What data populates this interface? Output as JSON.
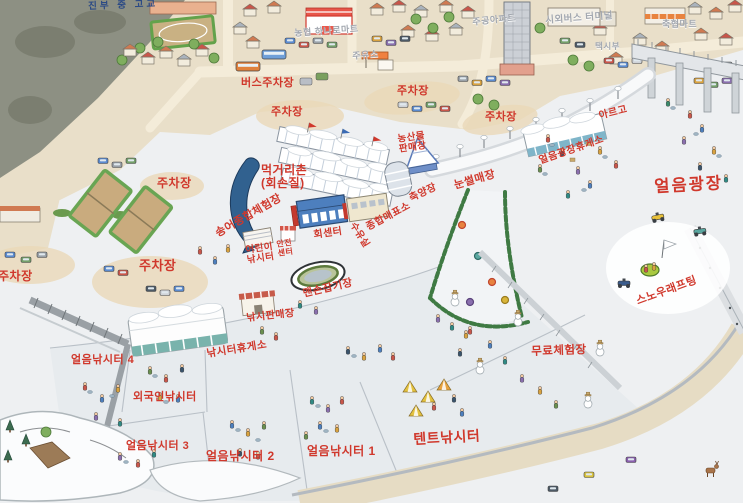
{
  "map": {
    "title_note": "illustrated winter festival site map",
    "colors": {
      "label_red": "#d0382c",
      "label_gray": "#a2a7af",
      "label_navy": "#2b4a85",
      "ice": "#eef0f2",
      "town": "#e9dfc9",
      "road": "#f4ecd9",
      "hill": "#8d9083",
      "fish_blue": "#31618f",
      "hedge_green": "#3f7a43",
      "tent_teal": "#79b3ac"
    },
    "labels": [
      {
        "id": "jinbu-school",
        "lines": [
          "진부 중 고교"
        ],
        "x": 88,
        "y": 2,
        "size": 9.5,
        "color": "navy",
        "rot": -2
      },
      {
        "id": "bus-parking",
        "lines": [
          "버스주차장"
        ],
        "x": 241,
        "y": 78,
        "size": 11,
        "color": "red",
        "rot": 0
      },
      {
        "id": "hanaro-mart",
        "lines": [
          "농협 하나로마트"
        ],
        "x": 294,
        "y": 29,
        "size": 9,
        "color": "gray",
        "rot": -4
      },
      {
        "id": "gas-station",
        "lines": [
          "주유소"
        ],
        "x": 352,
        "y": 52,
        "size": 9,
        "color": "gray",
        "rot": -5
      },
      {
        "id": "jugong-apartment",
        "lines": [
          "주공아파트"
        ],
        "x": 472,
        "y": 18,
        "size": 9,
        "color": "gray",
        "rot": -6
      },
      {
        "id": "intercity-bus-terminal",
        "lines": [
          "시외버스 터미널"
        ],
        "x": 545,
        "y": 16,
        "size": 9.5,
        "color": "gray",
        "rot": -4
      },
      {
        "id": "chukhyup-mart",
        "lines": [
          "축협마트"
        ],
        "x": 662,
        "y": 20,
        "size": 9,
        "color": "gray",
        "rot": 0
      },
      {
        "id": "taxi-stand",
        "lines": [
          "택시부"
        ],
        "x": 595,
        "y": 42,
        "size": 8.5,
        "color": "gray",
        "rot": 0
      },
      {
        "id": "parking-a",
        "lines": [
          "주차장"
        ],
        "x": 397,
        "y": 86,
        "size": 11,
        "color": "red",
        "rot": 0
      },
      {
        "id": "parking-b",
        "lines": [
          "주차장"
        ],
        "x": 271,
        "y": 107,
        "size": 11,
        "color": "red",
        "rot": 0
      },
      {
        "id": "parking-c",
        "lines": [
          "주차장"
        ],
        "x": 485,
        "y": 112,
        "size": 11,
        "color": "red",
        "rot": 0
      },
      {
        "id": "parking-d",
        "lines": [
          "주차장"
        ],
        "x": 157,
        "y": 177,
        "size": 12,
        "color": "red",
        "rot": 0
      },
      {
        "id": "parking-e",
        "lines": [
          "주차장"
        ],
        "x": 139,
        "y": 259,
        "size": 13,
        "color": "red",
        "rot": 0
      },
      {
        "id": "parking-f",
        "lines": [
          "주차장"
        ],
        "x": -2,
        "y": 270,
        "size": 12,
        "color": "red",
        "rot": 0
      },
      {
        "id": "argo",
        "lines": [
          "아르고"
        ],
        "x": 598,
        "y": 112,
        "size": 10,
        "color": "red",
        "rot": -14
      },
      {
        "id": "food-village",
        "lines": [
          "먹거리촌",
          "(회손질)"
        ],
        "x": 261,
        "y": 164,
        "size": 12,
        "color": "red",
        "rot": 0
      },
      {
        "id": "trout-experience",
        "lines": [
          "송어종합체험장"
        ],
        "x": 214,
        "y": 230,
        "size": 11,
        "color": "red",
        "rot": -30
      },
      {
        "id": "farm-products-market",
        "lines": [
          "농산물",
          "판매장"
        ],
        "x": 397,
        "y": 135,
        "size": 9.5,
        "color": "red",
        "rot": -8
      },
      {
        "id": "fish-holding-pond",
        "lines": [
          "축양장"
        ],
        "x": 408,
        "y": 195,
        "size": 10,
        "color": "red",
        "rot": -25
      },
      {
        "id": "ticket-office",
        "lines": [
          "종합매표소"
        ],
        "x": 365,
        "y": 224,
        "size": 10,
        "color": "red",
        "rot": -28
      },
      {
        "id": "sashimi-center",
        "lines": [
          "회센터"
        ],
        "x": 313,
        "y": 231,
        "size": 10,
        "color": "red",
        "rot": -8
      },
      {
        "id": "nursing-room",
        "lines": [
          "수유실"
        ],
        "x": 356,
        "y": 221,
        "size": 9.5,
        "color": "red",
        "rot": 58
      },
      {
        "id": "sledding-hill",
        "lines": [
          "눈썰매장"
        ],
        "x": 453,
        "y": 181,
        "size": 11,
        "color": "red",
        "rot": -16
      },
      {
        "id": "ice-plaza-rest-area",
        "lines": [
          "얼음광장휴게소"
        ],
        "x": 538,
        "y": 157,
        "size": 10,
        "color": "red",
        "rot": -19
      },
      {
        "id": "ice-plaza",
        "lines": [
          "얼음광장"
        ],
        "x": 654,
        "y": 179,
        "size": 16.5,
        "color": "red big",
        "rot": -3
      },
      {
        "id": "snow-rafting",
        "lines": [
          "스노우래프팅"
        ],
        "x": 635,
        "y": 297,
        "size": 11,
        "color": "red",
        "rot": -20
      },
      {
        "id": "kids-fishing",
        "lines": [
          "어린이",
          "낚시터"
        ],
        "x": 245,
        "y": 246,
        "size": 9.5,
        "color": "red",
        "rot": -8
      },
      {
        "id": "safety-center",
        "lines": [
          "안전",
          "센터"
        ],
        "x": 276,
        "y": 241,
        "size": 8,
        "color": "red",
        "rot": -8
      },
      {
        "id": "barehand-catching",
        "lines": [
          "맨손잡기장"
        ],
        "x": 302,
        "y": 289,
        "size": 10.5,
        "color": "red",
        "rot": -13
      },
      {
        "id": "tackle-shop",
        "lines": [
          "낚시판매장"
        ],
        "x": 246,
        "y": 314,
        "size": 10,
        "color": "red",
        "rot": -6
      },
      {
        "id": "fishing-rest-area",
        "lines": [
          "낚시터휴게소"
        ],
        "x": 206,
        "y": 349,
        "size": 10.5,
        "color": "red",
        "rot": -9
      },
      {
        "id": "ice-fishing-4",
        "lines": [
          "얼음낚시터 4"
        ],
        "x": 71,
        "y": 355,
        "size": 11,
        "color": "red",
        "rot": 0
      },
      {
        "id": "foreigner-fishing",
        "lines": [
          "외국인낚시터"
        ],
        "x": 133,
        "y": 392,
        "size": 11,
        "color": "red",
        "rot": 0
      },
      {
        "id": "ice-fishing-3",
        "lines": [
          "얼음낚시터 3"
        ],
        "x": 126,
        "y": 441,
        "size": 11,
        "color": "red",
        "rot": 0
      },
      {
        "id": "ice-fishing-2",
        "lines": [
          "얼음낚시터 2"
        ],
        "x": 206,
        "y": 450,
        "size": 12,
        "color": "red",
        "rot": 0
      },
      {
        "id": "ice-fishing-1",
        "lines": [
          "얼음낚시터 1"
        ],
        "x": 307,
        "y": 445,
        "size": 12,
        "color": "red",
        "rot": 0
      },
      {
        "id": "tent-fishing",
        "lines": [
          "텐트낚시터"
        ],
        "x": 413,
        "y": 432,
        "size": 14,
        "color": "red",
        "rot": -3
      },
      {
        "id": "free-experience",
        "lines": [
          "무료체험장"
        ],
        "x": 531,
        "y": 346,
        "size": 11.5,
        "color": "red",
        "rot": -2
      }
    ]
  }
}
